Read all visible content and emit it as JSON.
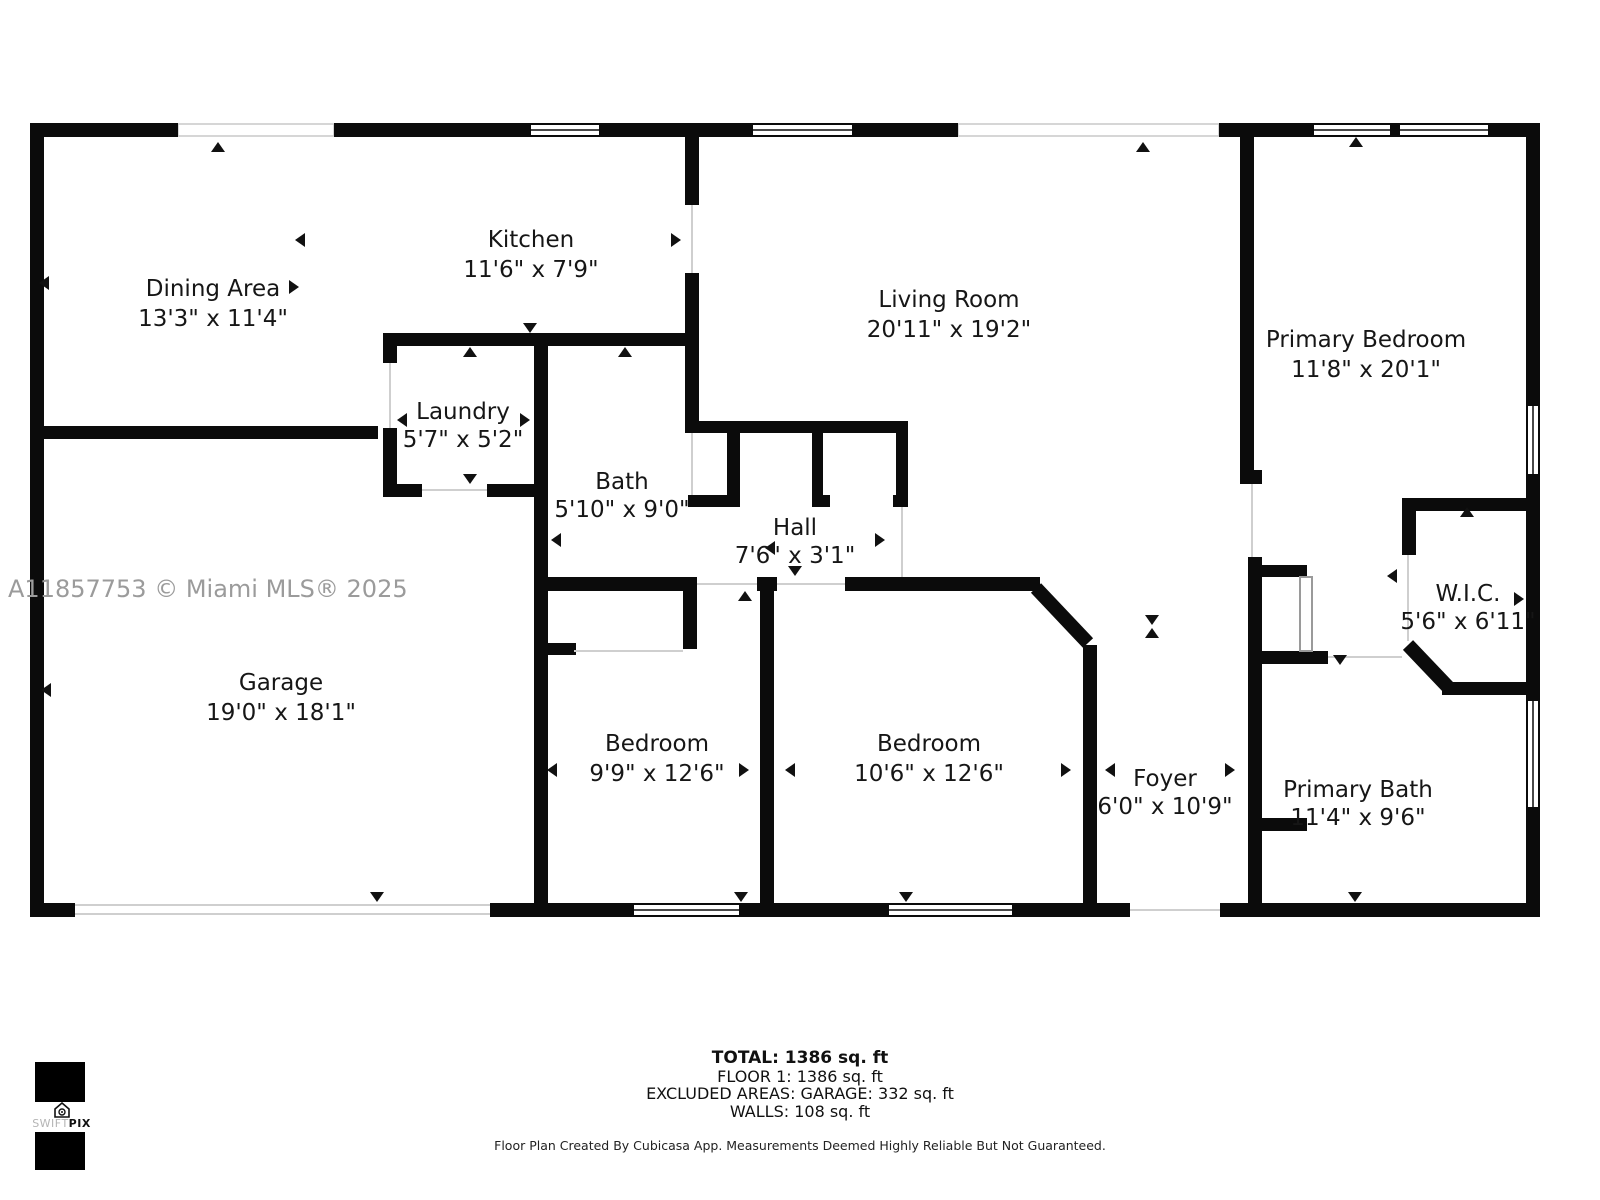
{
  "watermark": "A11857753 © Miami MLS® 2025",
  "rooms": [
    {
      "name": "Dining Area",
      "dims": "13'3\" x 11'4\""
    },
    {
      "name": "Kitchen",
      "dims": "11'6\" x 7'9\""
    },
    {
      "name": "Living Room",
      "dims": "20'11\" x 19'2\""
    },
    {
      "name": "Primary Bedroom",
      "dims": "11'8\" x 20'1\""
    },
    {
      "name": "Laundry",
      "dims": "5'7\" x 5'2\""
    },
    {
      "name": "Bath",
      "dims": "5'10\" x 9'0\""
    },
    {
      "name": "Hall",
      "dims": "7'6\" x 3'1\""
    },
    {
      "name": "Garage",
      "dims": "19'0\" x 18'1\""
    },
    {
      "name": "Bedroom",
      "dims": "9'9\" x 12'6\""
    },
    {
      "name": "Bedroom",
      "dims": "10'6\" x 12'6\""
    },
    {
      "name": "Foyer",
      "dims": "6'0\" x 10'9\""
    },
    {
      "name": "W.I.C.",
      "dims": "5'6\" x 6'11\""
    },
    {
      "name": "Primary Bath",
      "dims": "11'4\" x 9'6\""
    }
  ],
  "summary": {
    "total": "TOTAL: 1386 sq. ft",
    "floor": "FLOOR 1: 1386 sq. ft",
    "excluded": "EXCLUDED AREAS: GARAGE: 332 sq. ft",
    "walls": "WALLS: 108 sq. ft"
  },
  "disclaimer": "Floor Plan Created By Cubicasa App. Measurements Deemed Highly Reliable But Not Guaranteed.",
  "logo": {
    "swift": "SWIFT",
    "pix": "PIX"
  },
  "colors": {
    "wall": "#0b0b0b",
    "watermark": "#9b9b9b"
  }
}
